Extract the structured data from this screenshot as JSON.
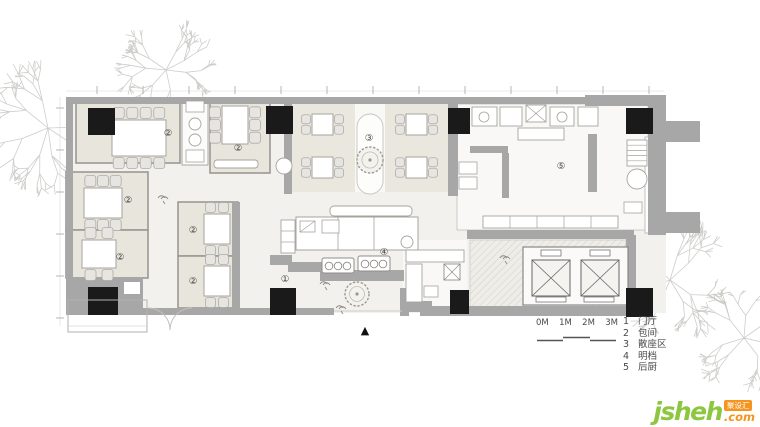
{
  "plan": {
    "markers": [
      {
        "symbol": "②",
        "x": 168,
        "y": 136
      },
      {
        "symbol": "②",
        "x": 238,
        "y": 151
      },
      {
        "symbol": "②",
        "x": 128,
        "y": 203
      },
      {
        "symbol": "②",
        "x": 120,
        "y": 260
      },
      {
        "symbol": "②",
        "x": 193,
        "y": 233
      },
      {
        "symbol": "②",
        "x": 193,
        "y": 284
      },
      {
        "symbol": "③",
        "x": 369,
        "y": 141
      },
      {
        "symbol": "④",
        "x": 384,
        "y": 255
      },
      {
        "symbol": "⑤",
        "x": 561,
        "y": 169
      },
      {
        "symbol": "①",
        "x": 285,
        "y": 282
      }
    ],
    "entrance_marker": "▲"
  },
  "scale_bar": {
    "labels": [
      "0M",
      "1M",
      "2M",
      "3M"
    ]
  },
  "legend": {
    "items": [
      {
        "num": "1",
        "label": "门厅"
      },
      {
        "num": "2",
        "label": "包间"
      },
      {
        "num": "3",
        "label": "散座区"
      },
      {
        "num": "4",
        "label": "明档"
      },
      {
        "num": "5",
        "label": "后厨"
      }
    ]
  },
  "watermark": {
    "brand": "jsheh",
    "tld": ".com",
    "badge": "聚设汇"
  },
  "colors": {
    "wall": "#a7a7a7",
    "column": "#1a1a1a",
    "room_floor": "#e8e5dc",
    "hall_floor": "#f2f1ee",
    "tree": "#c9c8c4",
    "brand_green": "#8dc63f",
    "brand_orange": "#f7941e"
  }
}
